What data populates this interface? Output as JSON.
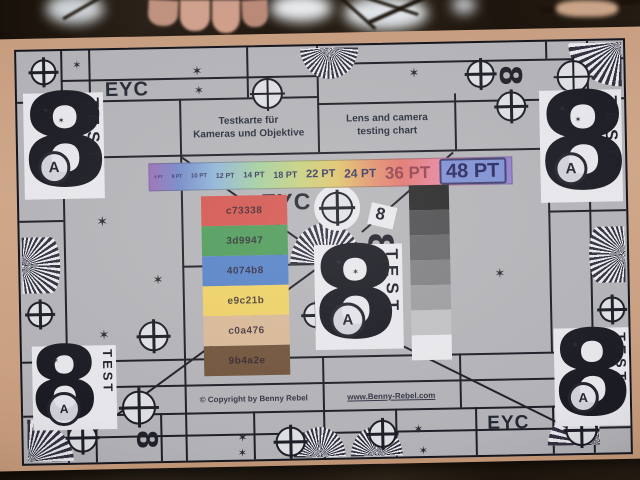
{
  "chart": {
    "labels": {
      "eyc": "EYC",
      "test": "TEST",
      "eight": "8",
      "a": "A",
      "infinity_eight": "8"
    },
    "titles": {
      "german_line1": "Testkarte für",
      "german_line2": "Kameras und Objektive",
      "english_line1": "Lens and camera",
      "english_line2": "testing chart"
    },
    "footer": {
      "copyright": "© Copyright by Benny Rebel",
      "website": "www.Benny-Rebel.com"
    },
    "pt_scale": {
      "labels": [
        "6 PT",
        "8 PT",
        "10 PT",
        "12 PT",
        "14 PT",
        "18 PT",
        "22 PT",
        "24 PT",
        "36 PT",
        "48 PT"
      ],
      "bar_gradient": "linear-gradient(90deg,#9a6db4 0%,#7287c8 8%,#8fb5d8 18%,#a4cf9e 30%,#c9d17c 42%,#e0c46a 52%,#e2906e 62%,#e2756e 70%,#e88bb0 84%,#a27cc6 94%,#8d7fd0 100%)",
      "box_fill": "#7e8fd4"
    },
    "color_patches": [
      {
        "label": "c73338",
        "fill": "#d4544d"
      },
      {
        "label": "3d9947",
        "fill": "#4d9a58"
      },
      {
        "label": "4074b8",
        "fill": "#5581c6"
      },
      {
        "label": "e9c21b",
        "fill": "#eed064"
      },
      {
        "label": "c0a476",
        "fill": "#d8b896"
      },
      {
        "label": "9b4a2e",
        "fill": "#6f5138"
      }
    ],
    "grayscale_steps": [
      "#262626",
      "#4c4c4e",
      "#646466",
      "#7e7e80",
      "#9c9c9e",
      "#c0c0c2",
      "#e8e8ec"
    ],
    "icons": {
      "crosshair-target": "circle-with-cross",
      "star-marker": "✶",
      "siemens-fan": "conic-ray-fan",
      "sideways-eight": "8 rotated 90°"
    }
  }
}
